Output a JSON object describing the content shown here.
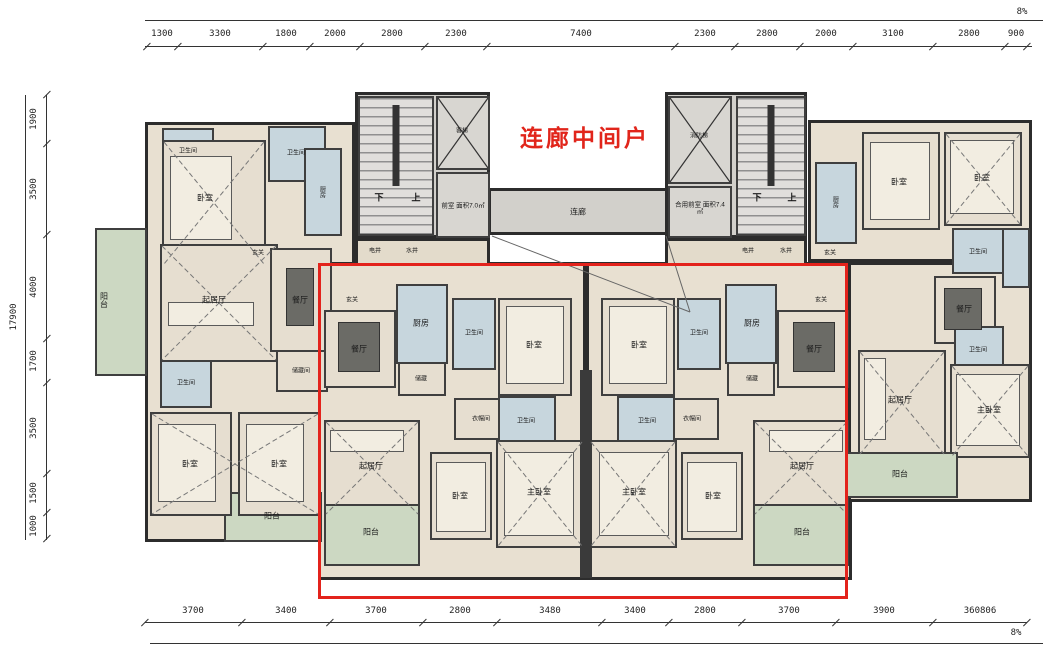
{
  "annotation": {
    "text": "连廊中间户"
  },
  "corridor_label": "连廊",
  "dims": {
    "top": [
      "1300",
      "3300",
      "1800",
      "2000",
      "2800",
      "2300",
      "7400",
      "2300",
      "2800",
      "2000",
      "3100",
      "2800",
      "900"
    ],
    "bottom": [
      "3700",
      "3400",
      "3700",
      "2800",
      "3480",
      "3400",
      "2800",
      "3700",
      "3900",
      "360806"
    ],
    "left": [
      "1900",
      "3500",
      "4000",
      "1700",
      "3500",
      "1500",
      "1000"
    ],
    "left_total": "17900",
    "mark_top_right": "8%",
    "mark_bottom_right": "8%"
  },
  "core": {
    "down": "下",
    "up": "上",
    "elevator_left": "客梯",
    "elevator_right": "消防梯",
    "lobby_left": "前室 面积7.0㎡",
    "lobby_right": "合用前室 面积7.4㎡",
    "shafts": [
      "电井",
      "水井"
    ]
  },
  "rooms": [
    "阳台",
    "卫生间",
    "卧室",
    "卫生间",
    "厨房",
    "玄关",
    "起居厅",
    "餐厅",
    "储藏间",
    "卫生间",
    "卧室",
    "卧室",
    "阳台",
    "玄关",
    "餐厅",
    "厨房",
    "储藏",
    "卫生间",
    "卧室",
    "衣帽间",
    "卫生间",
    "起居厅",
    "卧室",
    "主卧室",
    "阳台",
    "玄关",
    "餐厅",
    "厨房",
    "储藏",
    "卫生间",
    "卧室",
    "衣帽间",
    "卫生间",
    "起居厅",
    "卧室",
    "主卧室",
    "阳台",
    "厨房",
    "玄关",
    "卧室",
    "卧室",
    "卫生间",
    "餐厅",
    "卫生间",
    "起居厅",
    "主卧室",
    "阳台"
  ],
  "colors": {
    "wall": "#2c2c2c",
    "floor": "#e8e0d1",
    "wet_area": "#c7d6dd",
    "balcony": "#ccd8c2",
    "core": "#d8d6d1",
    "highlight_box": "#e3231c",
    "annotation_red": "#e1251b"
  }
}
